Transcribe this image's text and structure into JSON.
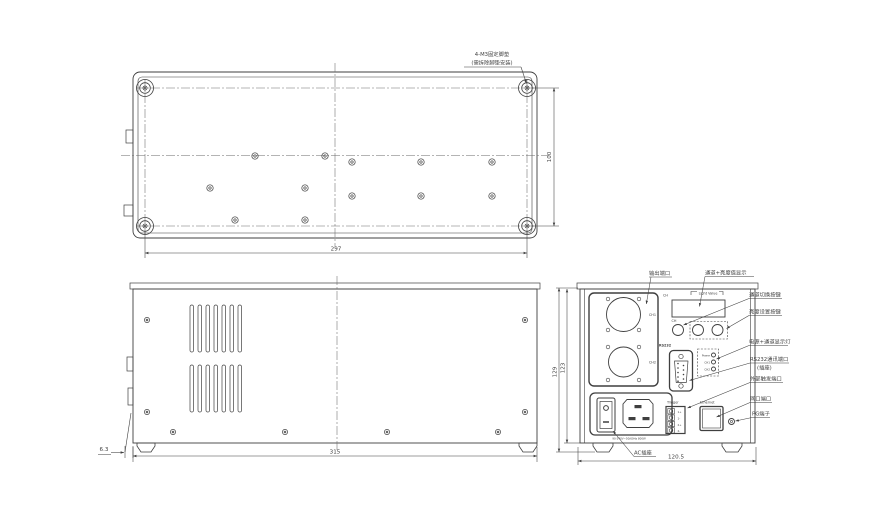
{
  "drawing": {
    "line_color": "#3f3f3f"
  },
  "top_view": {
    "note_line1": "4-M3固定脚垫",
    "note_line2": "(需拆除脚垫安装)",
    "dim_width": "297",
    "dim_height": "100"
  },
  "side_view": {
    "dim_length": "315",
    "dim_offset": "6.3"
  },
  "rear_view": {
    "dim_height_outer": "129",
    "dim_height_inner": "123",
    "dim_width": "120.5",
    "channel1_label": "CH1",
    "channel2_label": "CH2",
    "display_ch_label": "CH",
    "display_value_label": "Light Value",
    "button_ch_label": "CH",
    "rs232_label": "RS232",
    "led_labels": [
      "Power",
      "CH1",
      "CH2"
    ],
    "trigger_label": "Trigger",
    "trigger_pins": [
      "1+",
      "1-",
      "2+",
      "2-"
    ],
    "ethernet_label": "Ethernet",
    "power_text": "90-240V~50/60Hz 800W"
  },
  "annotations": {
    "output_port": "输出端口",
    "display": "通道+亮度值显示",
    "channel_switch": "通道切换按键",
    "brightness_set": "亮度设置按键",
    "indicator": "电源+通道显示灯",
    "rs232_line1": "RS232通讯端口",
    "rs232_line2": "(插座)",
    "trigger": "外部触发端口",
    "ethernet": "网口端口",
    "pg": "PG端子",
    "ac": "AC插座"
  }
}
